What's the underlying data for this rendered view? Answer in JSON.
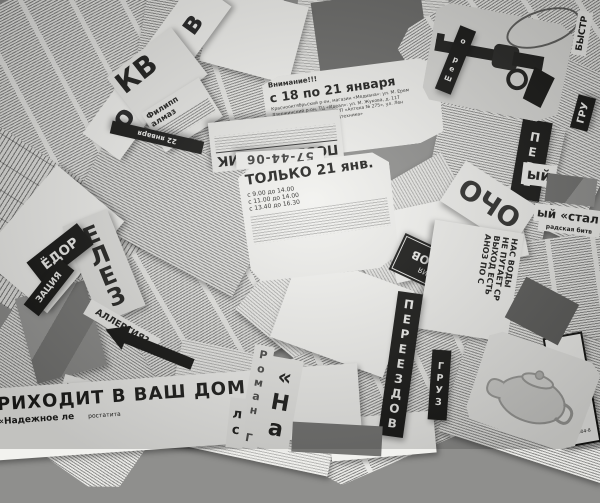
{
  "scene": {
    "description": "Monochrome photo collage of torn Russian newspaper classified-ad clippings scattered at random angles",
    "language": "ru",
    "palette": {
      "paper": "#e9e9e6",
      "ink": "#1a1a18",
      "banner": "#161614",
      "background": "#8f8f8d"
    }
  },
  "fragments": {
    "masthead_moskva": "осква в",
    "kv_big": "КВ",
    "filipp": "Филипп",
    "almaz": "алмаз",
    "black_bar_date": "22 января",
    "attention": "Внимание!!!",
    "promo_dates": "с 18 по 21 января",
    "promo_line1": "Краснооктябрьский р-он, магазин «Медиана»: ул. М. Ерем",
    "promo_line2": "Дзержинский р-он, ТЦ «Идеал»: ул. М. Жукова, д. 117",
    "promo_line3": "Тракторозаводский р-он, МУП «Аптека № 275», ул. Лен",
    "promo_line4": "Кировский р-он, отдел «Медтехника»",
    "pozvonochnik": "ПОЗВОНОЧНИК",
    "phone_1": "57-44-06",
    "phone_2": "тел. 98-71-91",
    "pere_vertical": "ПЕРЕ",
    "resh_vertical": "о реш",
    "bystr": "БЫСТР",
    "gru": "ГРУ",
    "only_21": "ТОЛЬКО 21 янв.",
    "sched_1": "с 9.00 до 14.00",
    "sched_2": "с 11.00 до 14.00",
    "sched_3": "с 13.40 до 16.30",
    "ocho": "ОЧО",
    "styi": "ый",
    "stal": "ый «стал",
    "stal_sub": "радская битв",
    "org_line1": "ОРГАНИЗАЦИЯ",
    "org_line2": "ПЕРЕЕЗДОВ",
    "yelez": "ЕЛЕЗ",
    "yodor": "ЁДОР",
    "zatsiya": "ЗАЦИЯ",
    "allergy": "АЛЛЕРГИЯ?",
    "dom_upside": "ДОМ",
    "vash_dom_headline": "РИХОДИТ В ВАШ ДОМ",
    "nadezhnoe": "«Надежное ле",
    "rostatita": "ростатита",
    "roman_vertical": "Роман Г",
    "na_vertical": "«На",
    "ls_vertical": "лс",
    "vody_1": "НАС ВОДЫ",
    "vody_2": "НЕ ПУГАЕТ СР",
    "vody_3": "ВЫХОД ЕСТЬ",
    "vody_4": "АНОЗ ПО С",
    "pereezdov_vertical": "ПЕРЕЕЗДОВ",
    "gruz_vertical": "ГРУЗ",
    "musor_banner": "ВЫВОЗ МУСОРА",
    "musor_phone": "т. 8-904-8"
  }
}
